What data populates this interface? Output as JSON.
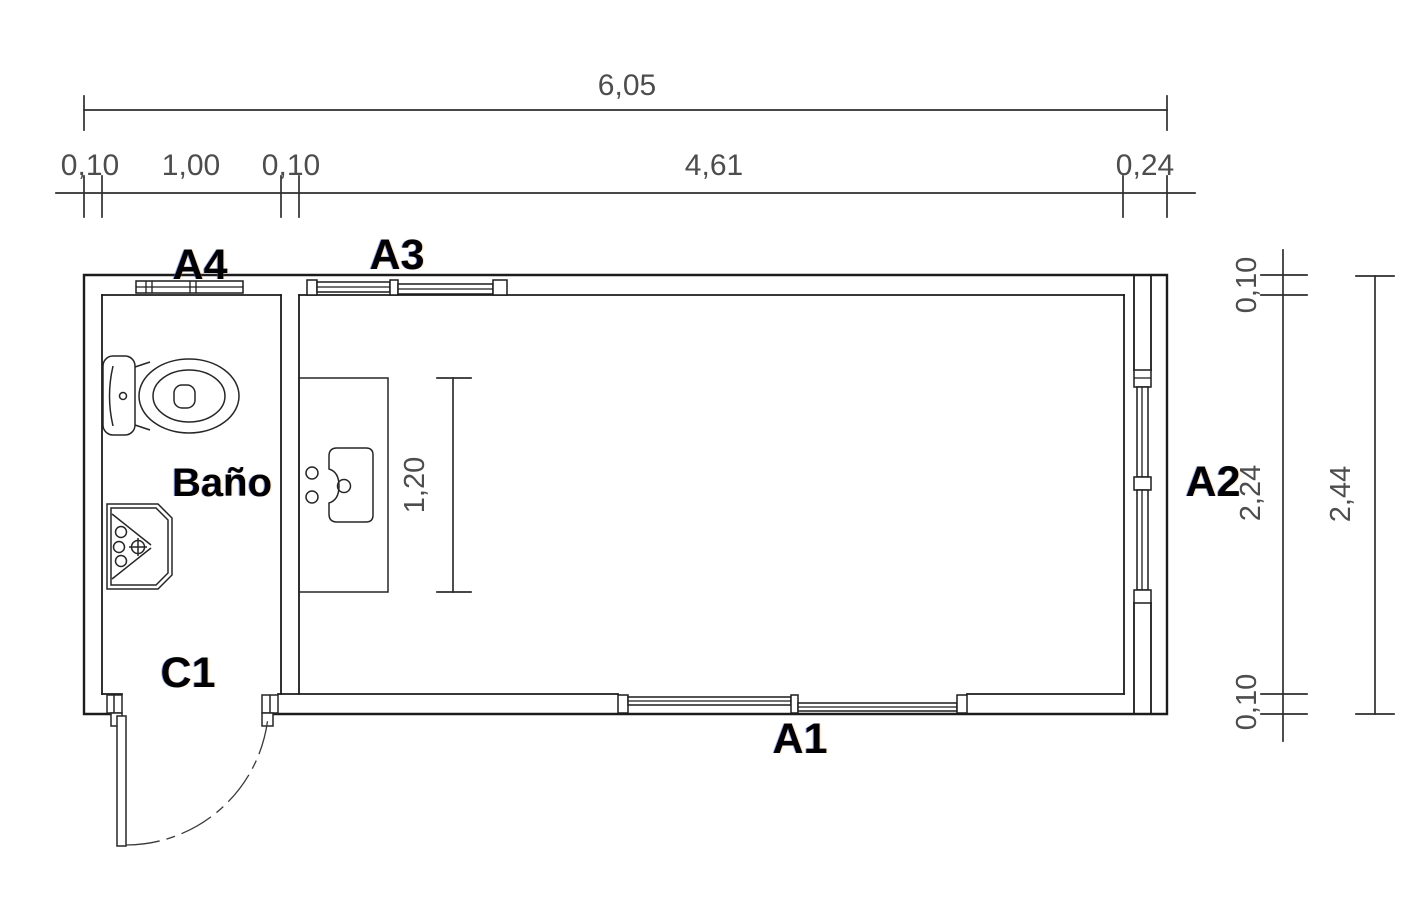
{
  "drawing": {
    "type": "floor-plan",
    "room": {
      "bathroom_label": "Baño"
    },
    "openings": {
      "door_label": "C1",
      "window_bottom_label": "A1",
      "window_right_label": "A2",
      "window_top_main_label": "A3",
      "window_top_bath_label": "A4"
    },
    "dimensions": {
      "total_width": "6,05",
      "top_segments": [
        "0,10",
        "1,00",
        "0,10",
        "4,61",
        "0,24"
      ],
      "counter_length": "1,20",
      "right_wall_top": "0,10",
      "interior_height": "2,24",
      "right_wall_bottom": "0,10",
      "total_height": "2,44"
    },
    "colors": {
      "background": "#ffffff",
      "line": "#1c1c1c",
      "dimension_text": "#4d4d4d",
      "label_text": "#000000"
    }
  }
}
